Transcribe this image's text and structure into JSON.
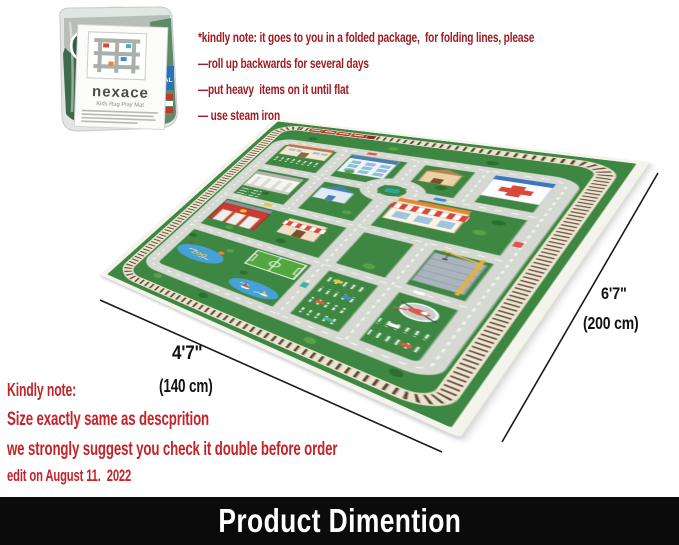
{
  "annotations": {
    "top_note": {
      "lines": [
        "*kindly note: it goes to you in a folded package,  for folding lines, please",
        "—roll up backwards for several days",
        "—put heavy  items on it until flat",
        "— use steam iron"
      ]
    },
    "bottom_note": {
      "heading": "Kindly note:",
      "lines": [
        "Size exactly same as descprition",
        "we strongly suggest you check it double before order",
        "edit on August 11.  2022"
      ]
    }
  },
  "dimensions": {
    "width_imperial": "4'7\"",
    "width_metric": "(140 cm)",
    "length_imperial": "6'7\"",
    "length_metric": "(200 cm)"
  },
  "package": {
    "brand": "nexace",
    "product_name": "Kids Rug Play Mat",
    "visible_side_text": "ITAL"
  },
  "rug": {
    "zoo_label": "ZOO"
  },
  "footer": {
    "title": "Product Dimention"
  },
  "colors": {
    "note_red": "#9e1c22",
    "accent_red": "#c2242a",
    "rug_green": "#3e8742",
    "road_gray": "#d6d8d2",
    "water_blue": "#45a1d8",
    "footer_bg": "#0b0b0b",
    "footer_text": "#ffffff"
  },
  "layout": {
    "rug_corners": [
      [
        275,
        119
      ],
      [
        650,
        162
      ],
      [
        460,
        438
      ],
      [
        100,
        275
      ]
    ]
  }
}
